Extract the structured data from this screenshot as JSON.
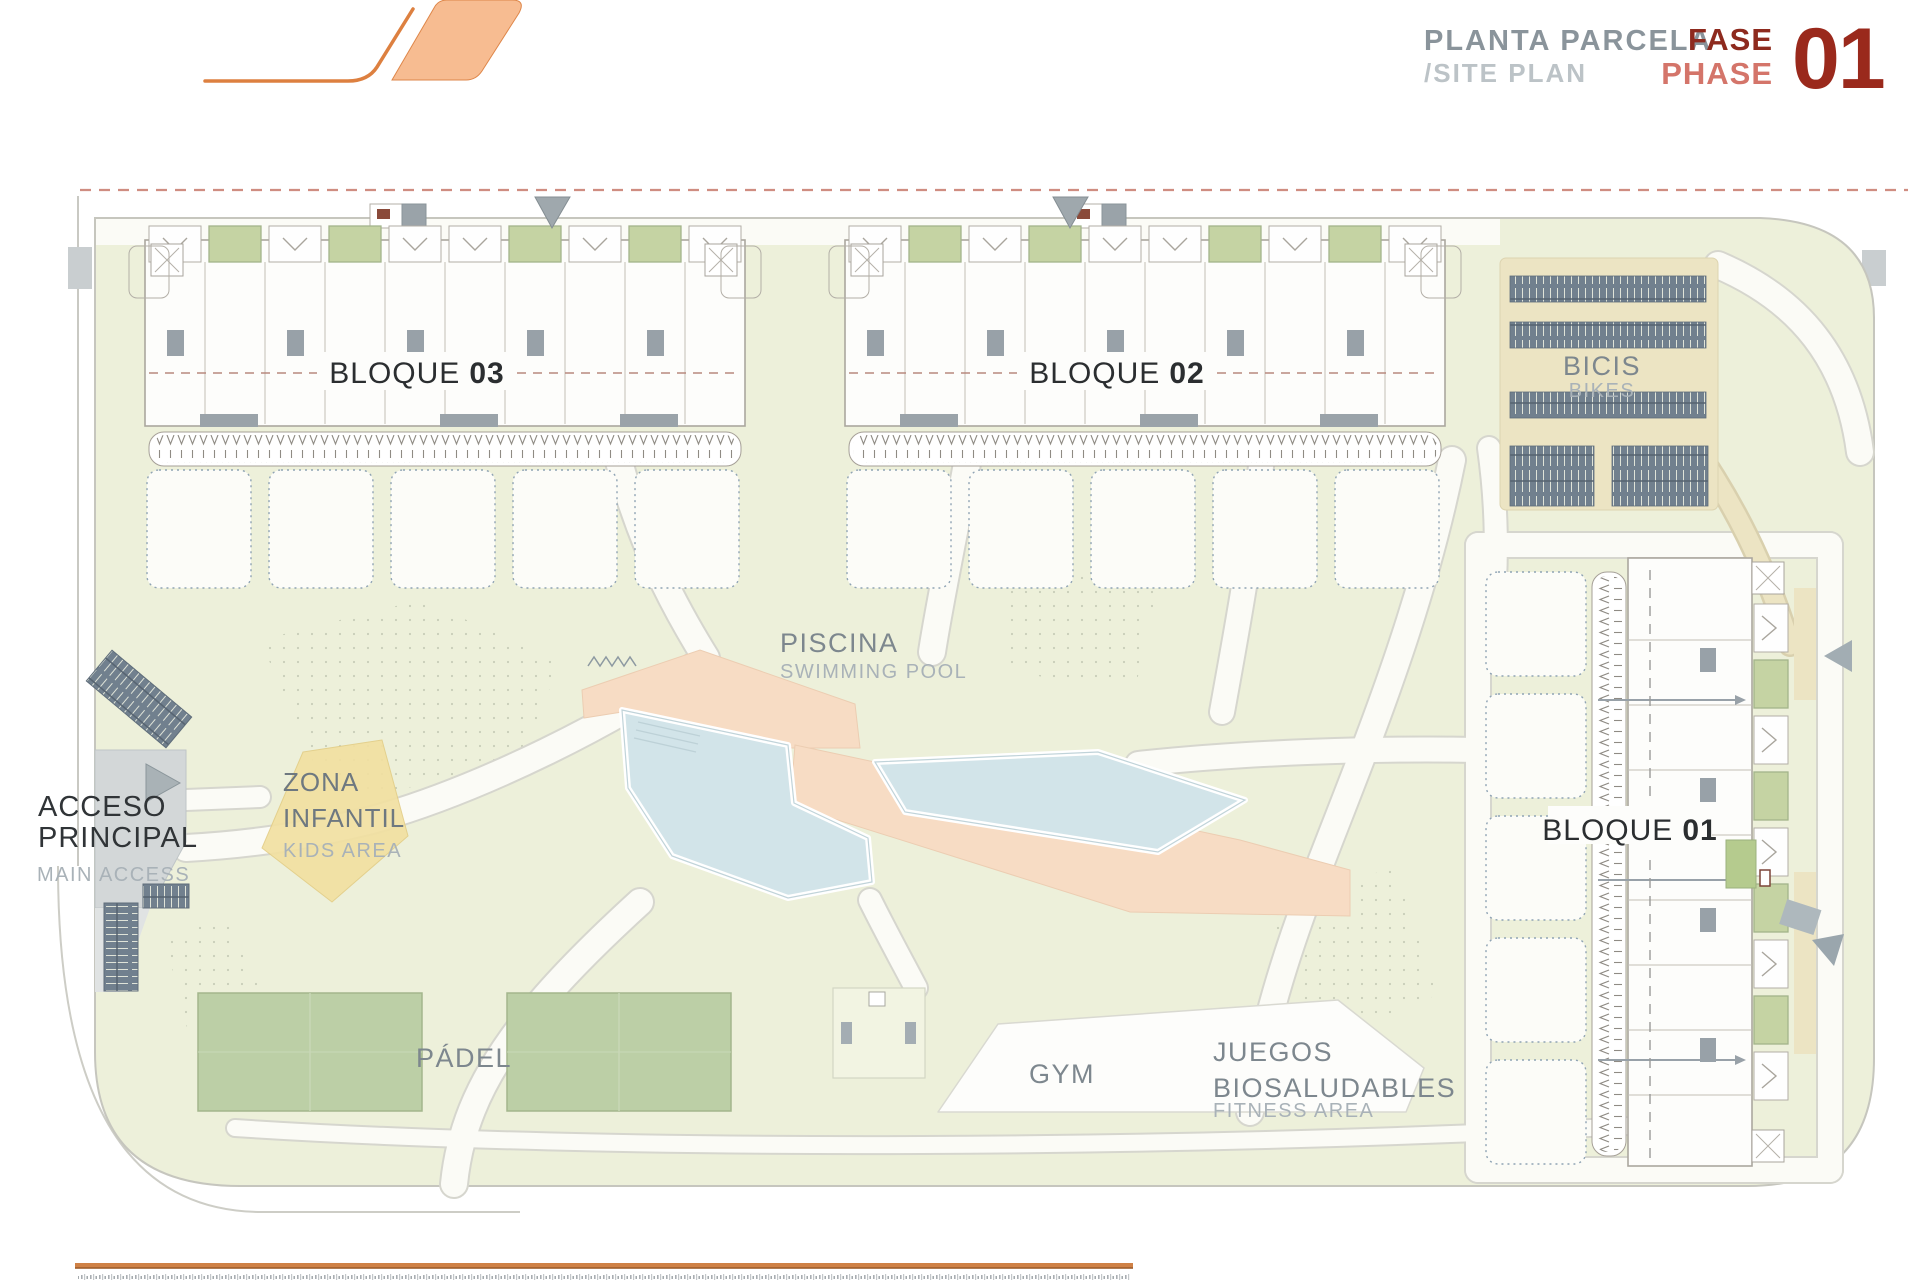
{
  "header": {
    "title_es": "PLANTA PARCELA",
    "title_en": "/SITE PLAN",
    "fase_label": "FASE",
    "phase_label": "PHASE",
    "phase_number": "01"
  },
  "plan": {
    "blocks": {
      "b1": {
        "word": "BLOQUE",
        "num": "01"
      },
      "b2": {
        "word": "BLOQUE",
        "num": "02"
      },
      "b3": {
        "word": "BLOQUE",
        "num": "03"
      }
    },
    "areas": {
      "bikes": {
        "label": "BICIS",
        "sublabel": "BIKES"
      },
      "pool": {
        "label": "PISCINA",
        "sublabel": "SWIMMING POOL"
      },
      "kids": {
        "line1": "ZONA",
        "line2": "INFANTIL",
        "sublabel": "KIDS AREA"
      },
      "access": {
        "line1": "ACCESO",
        "line2": "PRINCIPAL",
        "sublabel": "MAIN ACCESS"
      },
      "padel": {
        "label": "PÁDEL"
      },
      "gym": {
        "label": "GYM"
      },
      "fitness": {
        "line1": "JUEGOS",
        "line2": "BIOSALUDABLES",
        "sublabel": "FITNESS AREA"
      }
    },
    "colors": {
      "accent_orange": "#dd8040",
      "logo_fill": "#f7b98c",
      "phase_dark_red": "#9a291c",
      "phase_light_red": "#d4756a",
      "title_gray": "#8a949b",
      "subtitle_gray": "#bcc3c7",
      "lawn_green": "#edf0da",
      "court_green": "#bccfa6",
      "terrace_green": "#c5d3a3",
      "pool_blue": "#d2e4e9",
      "deck_peach": "#f7dcc4",
      "kids_yellow": "#f2e0a0",
      "bike_beige": "#ece4c3",
      "rack_slate": "#71808e",
      "boundary_dash_red": "#cf8d81",
      "label_gray": "#7d878e",
      "label_light_gray": "#a9b2b8",
      "label_dark": "#303437"
    }
  }
}
